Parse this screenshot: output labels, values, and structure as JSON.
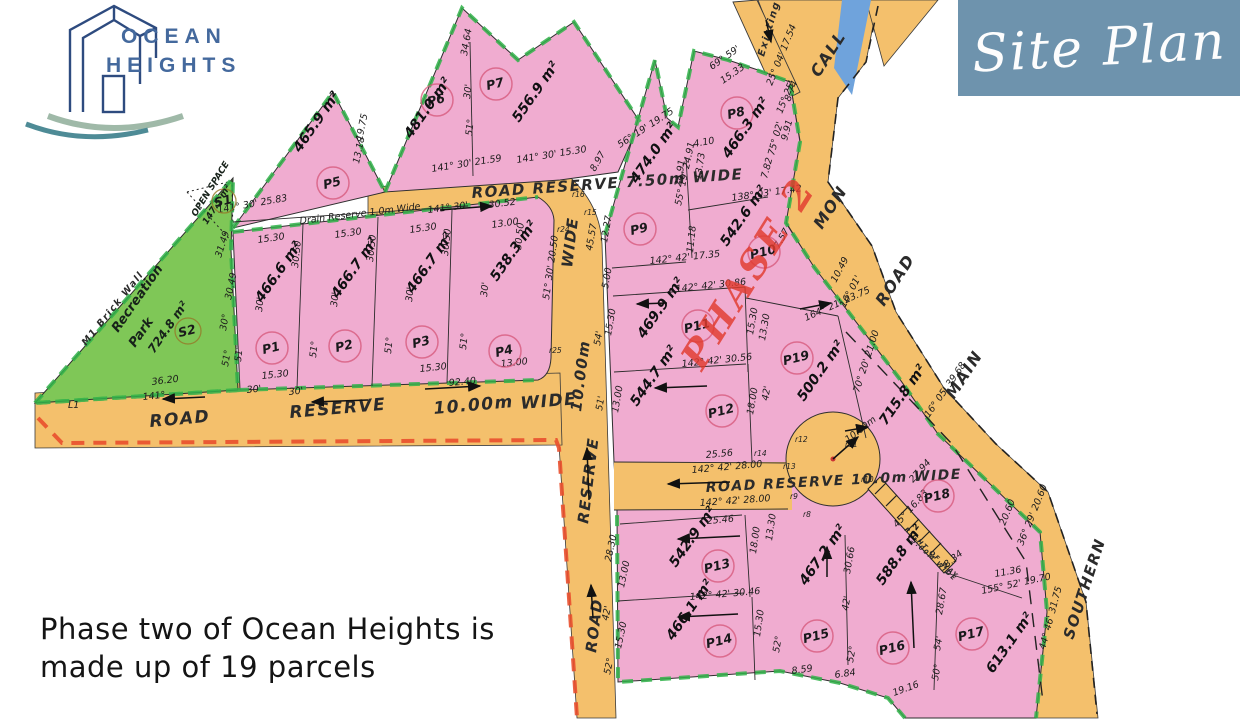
{
  "branding": {
    "line1": "OCEAN",
    "line2": "HEIGHTS"
  },
  "badge": {
    "title": "Site Plan",
    "bg": "#6E93AD"
  },
  "caption": {
    "line1": "Phase two of Ocean Heights is",
    "line2": "made up of 19  parcels"
  },
  "colors": {
    "road_orange": "#F4C06C",
    "parcel_pink": "#F0ACD0",
    "park_green": "#7FC757",
    "boundary_green_dash": "#31B24A",
    "boundary_red_dash": "#E94F2D",
    "stream_blue": "#6FA3DC",
    "phase_red": "#E23B2E",
    "badge_blue": "#6E93AD",
    "logo_blue": "#2E4B7F",
    "wave_teal": "#4E8B96",
    "wave_sage": "#9FB9A8"
  },
  "map": {
    "area_unit": "m²",
    "phase": [
      "PHASE 2",
      702,
      372,
      -58
    ],
    "parcels": [
      [
        "P1",
        "466.6",
        272,
        348,
        262,
        303
      ],
      [
        "P2",
        "466.7",
        345,
        346,
        338,
        299
      ],
      [
        "P3",
        "466.7",
        422,
        342,
        413,
        294
      ],
      [
        "P4",
        "538.3",
        505,
        351,
        497,
        282
      ],
      [
        "P5",
        "465.9",
        333,
        183,
        300,
        153
      ],
      [
        "P6",
        "481.0",
        437,
        100,
        411,
        139
      ],
      [
        "P7",
        "556.9",
        496,
        84,
        519,
        123
      ],
      [
        "P8",
        "466.3",
        737,
        113,
        729,
        159
      ],
      [
        "P9",
        "474.0",
        640,
        229,
        637,
        184
      ],
      [
        "P10",
        "542.6",
        764,
        252,
        727,
        247
      ],
      [
        "P11",
        "469.9",
        698,
        326,
        644,
        339
      ],
      [
        "P12",
        "544.7",
        722,
        411,
        637,
        407
      ],
      [
        "P13",
        "542.9",
        718,
        566,
        676,
        568
      ],
      [
        "P14",
        "466.1",
        720,
        641,
        673,
        641
      ],
      [
        "P15",
        "467.2",
        817,
        636,
        806,
        586
      ],
      [
        "P16",
        "588.8",
        893,
        648,
        883,
        586
      ],
      [
        "P17",
        "613.1",
        972,
        634,
        993,
        674
      ],
      [
        "P18",
        "715.8",
        938,
        496,
        886,
        426
      ],
      [
        "P19",
        "500.2",
        797,
        358,
        804,
        402
      ]
    ],
    "sites": [
      {
        "id": "S1",
        "cx": 224,
        "cy": 201,
        "r": 12,
        "labels": [
          [
            "OPEN SPACE",
            196,
            217,
            -58,
            9
          ],
          [
            "147.5 m²",
            207,
            225,
            -58,
            9
          ]
        ]
      },
      {
        "id": "S2",
        "cx": 188,
        "cy": 331,
        "r": 13,
        "labels": [
          [
            "Recreation",
            118,
            333,
            -55,
            13
          ],
          [
            "Park",
            135,
            348,
            -55,
            13
          ],
          [
            "724.8 m²",
            154,
            354,
            -55,
            12
          ]
        ]
      }
    ],
    "road_labels": [
      [
        "ROAD RESERVE 7.50m WIDE",
        472,
        198,
        -4,
        15
      ],
      [
        "ROAD",
        150,
        427,
        -5,
        17
      ],
      [
        "RESERVE",
        290,
        418,
        -5,
        17
      ],
      [
        "10.00m",
        434,
        414,
        -5,
        17
      ],
      [
        "WIDE",
        521,
        409,
        -5,
        17
      ],
      [
        "WIDE",
        572,
        268,
        -83,
        15
      ],
      [
        "10.00m",
        581,
        412,
        -83,
        15
      ],
      [
        "RESERVE",
        588,
        524,
        -83,
        15
      ],
      [
        "ROAD",
        596,
        653,
        -83,
        15
      ],
      [
        "ROAD RESERVE 10.0m WIDE",
        706,
        492,
        -3,
        14
      ],
      [
        "CALL",
        819,
        78,
        -57,
        16
      ],
      [
        "MON",
        822,
        230,
        -57,
        16
      ],
      [
        "ROAD",
        884,
        307,
        -57,
        16
      ],
      [
        "MAIN",
        954,
        400,
        -57,
        16
      ],
      [
        "SOUTHERN",
        1073,
        640,
        -72,
        15
      ],
      [
        "Existing Trac",
        764,
        57,
        -74,
        10
      ],
      [
        "RIGHT OF WAY",
        904,
        530,
        43,
        6.5
      ],
      [
        "5.00M WIDE",
        911,
        541,
        43,
        6.5
      ],
      [
        "M1 Brick Wall",
        86,
        346,
        -51,
        9.5
      ]
    ],
    "dimensions": [
      [
        "141° 30' 25.83",
        218,
        213,
        -10
      ],
      [
        "Drain Reserve 1.0m Wide",
        300,
        224,
        -7
      ],
      [
        "15.30",
        258,
        243,
        -8
      ],
      [
        "15.30",
        335,
        238,
        -8
      ],
      [
        "15.30",
        410,
        233,
        -8
      ],
      [
        "13.00",
        492,
        228,
        -8
      ],
      [
        "30.50",
        298,
        268,
        -84
      ],
      [
        "30.50",
        373,
        262,
        -84
      ],
      [
        "30.50",
        448,
        256,
        -84
      ],
      [
        "30.50",
        521,
        250,
        -84
      ],
      [
        "30'",
        262,
        312,
        -84
      ],
      [
        "30'",
        337,
        307,
        -84
      ],
      [
        "30'",
        412,
        302,
        -84
      ],
      [
        "30'",
        487,
        297,
        -84
      ],
      [
        "51°",
        241,
        362,
        -84
      ],
      [
        "51°",
        316,
        358,
        -84
      ],
      [
        "51°",
        391,
        354,
        -84
      ],
      [
        "51°",
        466,
        350,
        -84
      ],
      [
        "15.30",
        262,
        379,
        -6
      ],
      [
        "30'",
        247,
        393,
        -6
      ],
      [
        "15.30",
        420,
        372,
        -6
      ],
      [
        "13.00",
        501,
        367,
        -6
      ],
      [
        "92.40",
        449,
        386,
        -5
      ],
      [
        "36.20",
        152,
        385,
        -7
      ],
      [
        "141°",
        143,
        400,
        -6
      ],
      [
        "30'",
        289,
        395,
        -6
      ],
      [
        "31.49",
        221,
        258,
        -72
      ],
      [
        "30.49",
        231,
        300,
        -78
      ],
      [
        "30°",
        226,
        331,
        -80
      ],
      [
        "51°",
        228,
        367,
        -80
      ],
      [
        "51° 30' 20.50",
        549,
        300,
        -82
      ],
      [
        "141° 30' 21.59",
        432,
        172,
        -9
      ],
      [
        "141° 30' 15.30",
        517,
        163,
        -9
      ],
      [
        "141° 30'",
        428,
        213,
        -7
      ],
      [
        "30.52",
        489,
        208,
        -7
      ],
      [
        "19.75",
        362,
        141,
        -78
      ],
      [
        "13.18",
        359,
        164,
        -78
      ],
      [
        "34.64",
        467,
        56,
        -80
      ],
      [
        "30'",
        470,
        99,
        -84
      ],
      [
        "51°",
        472,
        136,
        -84
      ],
      [
        "69° 59'",
        712,
        70,
        -35
      ],
      [
        "15.33",
        723,
        84,
        -35
      ],
      [
        "25° 04' 17.54",
        772,
        86,
        -68
      ],
      [
        "8.74",
        790,
        102,
        -68
      ],
      [
        "56° 19' 19.75",
        620,
        148,
        -33
      ],
      [
        "8.97",
        595,
        172,
        -60
      ],
      [
        "4.10",
        694,
        147,
        -10
      ],
      [
        "13.73",
        701,
        180,
        -82
      ],
      [
        "24.91",
        681,
        187,
        -82
      ],
      [
        "15° 25'",
        782,
        114,
        -68
      ],
      [
        "75° 02'",
        774,
        156,
        -75
      ],
      [
        "7.82",
        767,
        179,
        -75
      ],
      [
        "9.91",
        787,
        141,
        -75
      ],
      [
        "138° 03' 17.42",
        732,
        201,
        -8
      ],
      [
        "7.57",
        779,
        249,
        -60
      ],
      [
        "10.49",
        836,
        283,
        -62
      ],
      [
        "16° 01'",
        845,
        308,
        -62
      ],
      [
        "12.27",
        607,
        243,
        -80
      ],
      [
        "45.57",
        592,
        251,
        -80
      ],
      [
        "5.00",
        608,
        289,
        -80
      ],
      [
        "15.30",
        611,
        336,
        -80
      ],
      [
        "55° 19' 24.91",
        681,
        206,
        -78
      ],
      [
        "11.18",
        693,
        253,
        -84
      ],
      [
        "142° 42' 17.35",
        650,
        264,
        -6
      ],
      [
        "142° 42' 30.86",
        676,
        292,
        -6
      ],
      [
        "164° 21' 23.75",
        806,
        321,
        -24
      ],
      [
        "15.30",
        753,
        335,
        -80
      ],
      [
        "13.30",
        765,
        341,
        -80
      ],
      [
        "54'",
        600,
        346,
        -80
      ],
      [
        "51'",
        602,
        411,
        -80
      ],
      [
        "142° 42' 30.56",
        682,
        367,
        -6
      ],
      [
        "13.00",
        618,
        413,
        -80
      ],
      [
        "18.00",
        753,
        415,
        -80
      ],
      [
        "42'",
        768,
        401,
        -80
      ],
      [
        "70° 20' 21.00",
        859,
        393,
        -72
      ],
      [
        "25.56",
        706,
        458,
        -5
      ],
      [
        "142° 42' 28.00",
        692,
        473,
        -5
      ],
      [
        "142° 42' 28.00",
        700,
        506,
        -4
      ],
      [
        "25.46",
        707,
        524,
        -5
      ],
      [
        "10.00m",
        848,
        443,
        -38
      ],
      [
        "142° 42' 30.46",
        690,
        600,
        -5
      ],
      [
        "18.00",
        756,
        554,
        -82
      ],
      [
        "13.30",
        772,
        541,
        -82
      ],
      [
        "30.66",
        850,
        574,
        -80
      ],
      [
        "42'",
        848,
        611,
        -80
      ],
      [
        "15.30",
        760,
        637,
        -82
      ],
      [
        "13.00",
        624,
        588,
        -78
      ],
      [
        "28.30",
        611,
        562,
        -78
      ],
      [
        "42'",
        608,
        621,
        -78
      ],
      [
        "15.30",
        621,
        649,
        -78
      ],
      [
        "52°",
        610,
        675,
        -78
      ],
      [
        "52°",
        779,
        653,
        -80
      ],
      [
        "52°",
        853,
        663,
        -80
      ],
      [
        "8.59",
        792,
        674,
        -8
      ],
      [
        "6.84",
        835,
        678,
        -8
      ],
      [
        "19.16",
        894,
        696,
        -20
      ],
      [
        "28.67",
        942,
        615,
        -80
      ],
      [
        "54'",
        940,
        651,
        -80
      ],
      [
        "50°",
        938,
        681,
        -80
      ],
      [
        "155° 52' 19.70",
        982,
        594,
        -12
      ],
      [
        "11.36",
        995,
        577,
        -10
      ],
      [
        "8.34",
        947,
        568,
        -40
      ],
      [
        "27.94",
        913,
        483,
        -48
      ],
      [
        "45° 16.83",
        897,
        528,
        -48
      ],
      [
        "16° 05' 39.68",
        929,
        418,
        -55
      ],
      [
        "36° 29' 20.60",
        1023,
        546,
        -68
      ],
      [
        "20.60",
        1005,
        526,
        -68
      ],
      [
        "44° 46' 31.75",
        1045,
        650,
        -75
      ],
      [
        "L1",
        68,
        408,
        0
      ]
    ],
    "markers": [
      [
        "r8",
        803,
        517
      ],
      [
        "r9",
        790,
        499
      ],
      [
        "r10",
        861,
        482
      ],
      [
        "r11",
        845,
        447
      ],
      [
        "r12",
        795,
        442
      ],
      [
        "r13",
        783,
        469
      ],
      [
        "r14",
        754,
        456
      ],
      [
        "r15",
        584,
        215
      ],
      [
        "r16",
        572,
        197
      ],
      [
        "r24",
        557,
        232
      ],
      [
        "r25",
        549,
        353
      ]
    ],
    "arrows": [
      [
        205,
        397,
        163,
        399
      ],
      [
        368,
        400,
        312,
        402
      ],
      [
        425,
        389,
        480,
        386
      ],
      [
        440,
        210,
        492,
        206
      ],
      [
        589,
        500,
        587,
        448
      ],
      [
        593,
        618,
        591,
        585
      ],
      [
        730,
        482,
        668,
        484
      ],
      [
        740,
        536,
        678,
        539
      ],
      [
        738,
        614,
        678,
        617
      ],
      [
        827,
        577,
        827,
        547
      ],
      [
        914,
        648,
        911,
        582
      ],
      [
        667,
        303,
        637,
        304
      ],
      [
        707,
        386,
        655,
        388
      ],
      [
        800,
        309,
        831,
        303
      ],
      [
        845,
        431,
        868,
        427
      ],
      [
        766,
        20,
        771,
        42
      ],
      [
        833,
        459,
        858,
        437
      ]
    ]
  }
}
